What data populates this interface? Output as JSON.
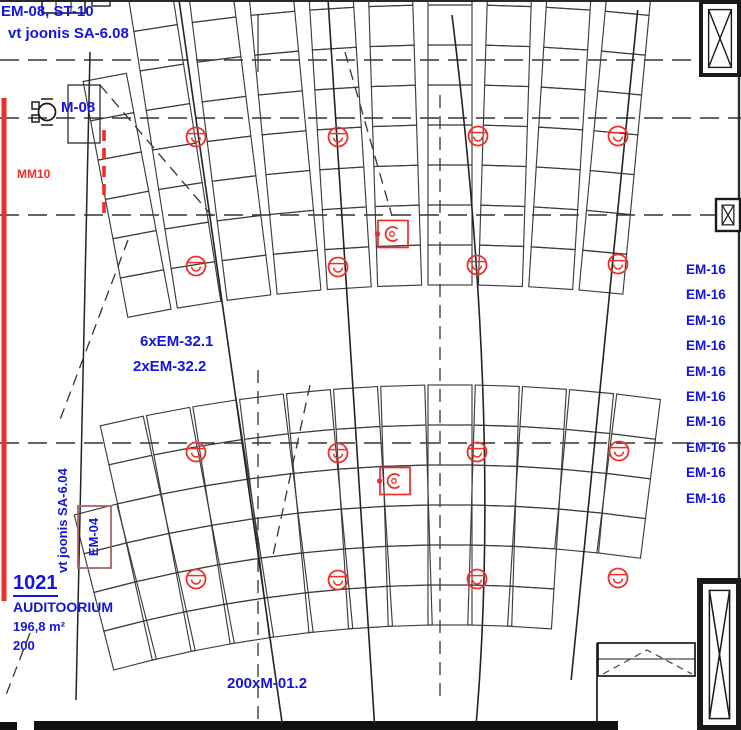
{
  "drawing": {
    "labels": {
      "top_note_line1": "EM-08, ST-10",
      "top_note_line2": "vt joonis SA-6.08",
      "m08": "M-08",
      "mm10": "MM10",
      "em32_line1": "6xEM-32.1",
      "em32_line2": "2xEM-32.2",
      "em04": "EM-04",
      "sa604_note": "vt joonis SA-6.04",
      "bottom_note": "200xM-01.2"
    },
    "room": {
      "number": "1021",
      "name": "AUDITOORIUM",
      "area": "196,8 m²",
      "capacity": "200"
    },
    "em16": {
      "items": [
        "EM-16",
        "EM-16",
        "EM-16",
        "EM-16",
        "EM-16",
        "EM-16",
        "EM-16",
        "EM-16",
        "EM-16",
        "EM-16"
      ]
    },
    "symbols": {
      "detectors": [
        [
          196,
          137
        ],
        [
          338,
          137
        ],
        [
          478,
          136
        ],
        [
          618,
          136
        ],
        [
          196,
          266
        ],
        [
          338,
          267
        ],
        [
          477,
          265
        ],
        [
          618,
          264
        ],
        [
          196,
          452
        ],
        [
          338,
          453
        ],
        [
          477,
          452
        ],
        [
          619,
          451
        ],
        [
          196,
          579
        ],
        [
          338,
          580
        ],
        [
          477,
          579
        ],
        [
          618,
          578
        ]
      ],
      "fixtures": [
        [
          393,
          234
        ],
        [
          395,
          481
        ]
      ]
    },
    "colors": {
      "label_blue": "#1414dd",
      "annotation_red": "#ee2e28",
      "em04_box": "#a86464",
      "line_dark": "#333333",
      "seat_line": "#3c3c3c"
    }
  }
}
